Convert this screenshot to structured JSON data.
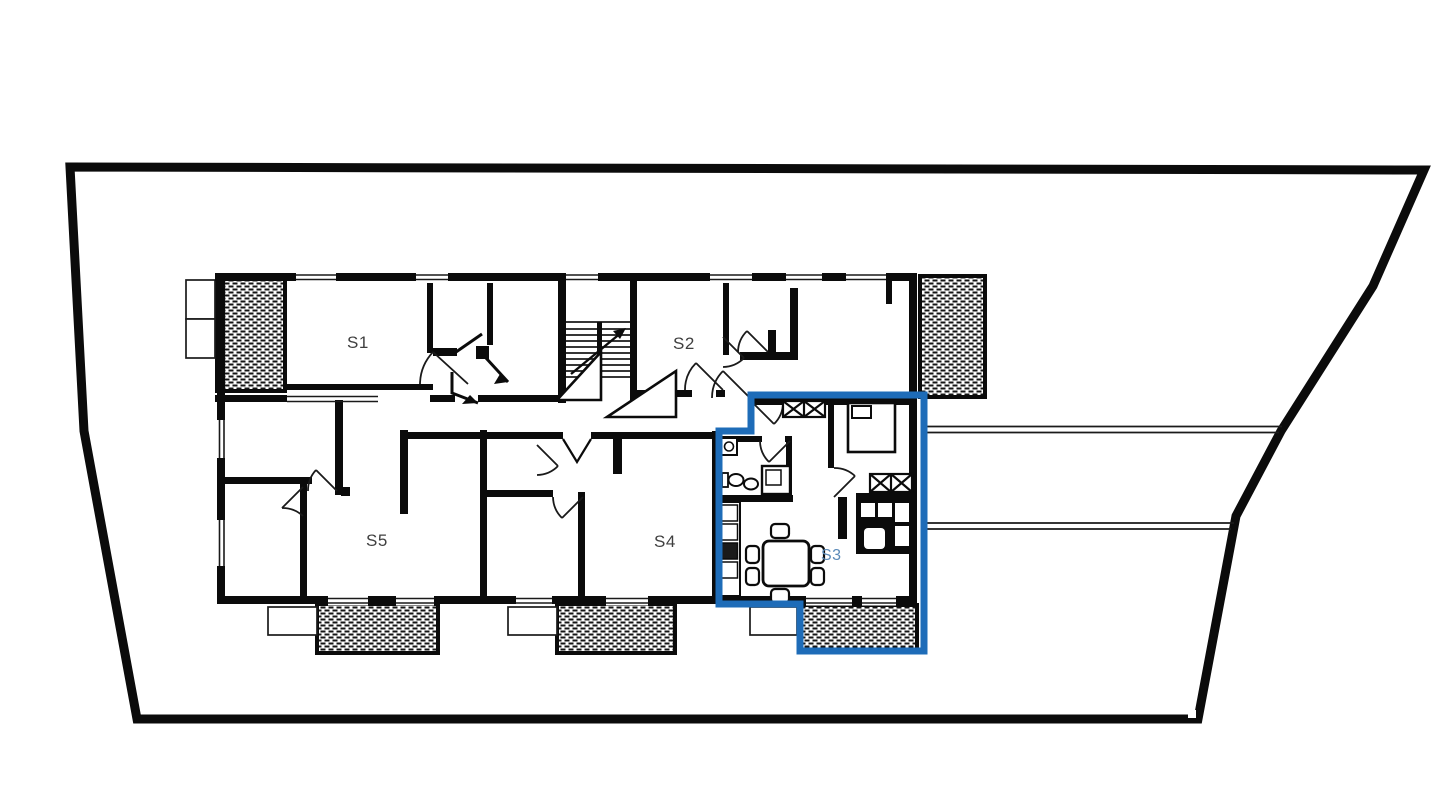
{
  "plan": {
    "type": "apartment-floor-plan",
    "units": [
      {
        "id": "s1",
        "label": "S1",
        "highlighted": false
      },
      {
        "id": "s2",
        "label": "S2",
        "highlighted": false
      },
      {
        "id": "s3",
        "label": "S3",
        "highlighted": true
      },
      {
        "id": "s4",
        "label": "S4",
        "highlighted": false
      },
      {
        "id": "s5",
        "label": "S5",
        "highlighted": false
      }
    ],
    "highlighted_unit": "S3",
    "colors": {
      "walls": "#0b0b0b",
      "background": "#ffffff",
      "highlight_outline": "#1e6cb8",
      "highlight_label": "#5b8ab8",
      "label": "#3f3f3f"
    }
  }
}
